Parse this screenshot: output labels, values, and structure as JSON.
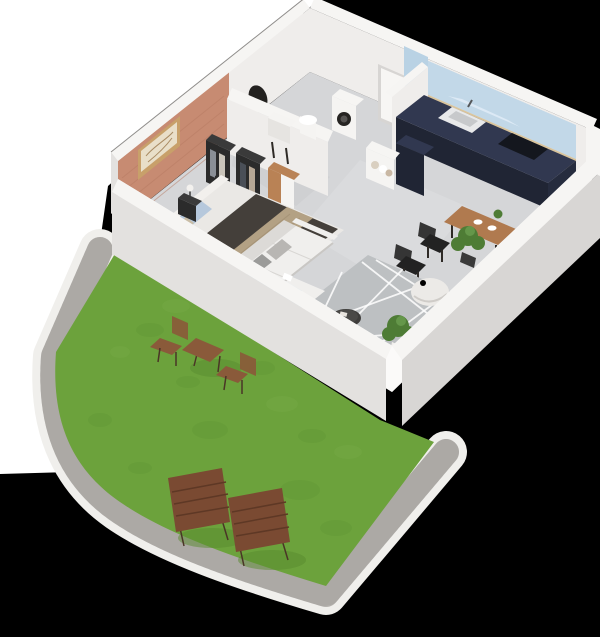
{
  "scene": {
    "type": "3d-isometric-floor-plan-render",
    "subject": "One-bedroom apartment cutaway with private lawn garden",
    "rooms": [
      "bedroom",
      "bathroom",
      "entry",
      "kitchen",
      "dining-area",
      "living-room",
      "garden"
    ],
    "furnishings": {
      "bedroom": [
        "double-bed",
        "blue-pillows",
        "dark-duvet",
        "beige-throw",
        "nightstand-lamp",
        "open-wardrobes",
        "closet",
        "wall-art",
        "brick-accent-wall",
        "potted-tree"
      ],
      "bathroom": [
        "round-mirror",
        "vanity-sink",
        "basin",
        "washing-machine"
      ],
      "entry": [
        "front-door",
        "partition-wall"
      ],
      "kitchen": [
        "navy-l-counter",
        "light-blue-backsplash",
        "wood-slat-band",
        "sink",
        "cooktop",
        "open-shelf-dishes"
      ],
      "dining-area": [
        "wood-table",
        "black-chairs",
        "plates",
        "table-plant"
      ],
      "living-room": [
        "white-corner-sofa",
        "gray-cushions",
        "geometric-rug",
        "round-coffee-table",
        "bean-bag",
        "potted-plants",
        "glass-sliding-door"
      ],
      "garden": [
        "lawn",
        "gravel-path",
        "white-curb",
        "folding-bistro-table",
        "folding-chairs",
        "two-sun-loungers"
      ]
    }
  },
  "colors": {
    "background": "#000000",
    "backdrop": "#ffffff",
    "lawn": "#6ca23c",
    "lawnShade": "#578a2e",
    "lawnLight": "#7cb04a",
    "gravel": "#b5b2ae",
    "gravelDark": "#9b9894",
    "curb": "#f0efec",
    "floor": "#d5d6d8",
    "floorLight": "#dee0e2",
    "floorDark": "#c9cacc",
    "wallTop": "#f6f5f3",
    "wallInterior": "#efedeb",
    "wallExterior": "#e3e1df",
    "brick": "#c78b72",
    "brickShade": "#b67a62",
    "artFrame": "#c8a06a",
    "artPaper": "#e9dfc9",
    "glass": "#cfe0ec",
    "door": "#f7f6f4",
    "doorFrame": "#d7d5d3",
    "kitchenCabinet": "#262c3e",
    "kitchenCabinetFront": "#202534",
    "kitchenCabinetTop": "#313850",
    "backsplash": "#c2d8e8",
    "upperCabinet": "#b9d2e4",
    "woodBand": "#d9c49c",
    "cooktop": "#14171e",
    "stainless": "#e8e9ea",
    "applianceWhite": "#f5f4f2",
    "machineDoor": "#262422",
    "mirrorDark": "#23211f",
    "bedFrame": "#eae8e5",
    "headboard": "#f2f0ed",
    "duvet": "#443f3a",
    "throw": "#b3a184",
    "pillowBlue": "#a9bdd3",
    "pillowBlue2": "#b6c8dc",
    "pillowBeige": "#c9bda6",
    "wardrobeDark": "#2b2b2b",
    "wardrobeTop": "#3a3a3a",
    "closetWood": "#b98255",
    "sofa": "#f0efed",
    "sofaShadow": "#dcdad7",
    "cushionGray": "#9b9b99",
    "cushionLight": "#b8b6b3",
    "rug": "#bdc0c2",
    "coffeeTable": "#3d3c3a",
    "beanbag": "#eceae7",
    "plantGreen": "#4e7c35",
    "plantLight": "#65974a",
    "potDark": "#3a3a3a",
    "potWhite": "#f1efec",
    "tableWood": "#b07a4f",
    "chairBlack": "#222222",
    "lounger": "#7a4a32",
    "loungerSlat": "#5e3825",
    "bistroWood": "#8a5a3a"
  }
}
